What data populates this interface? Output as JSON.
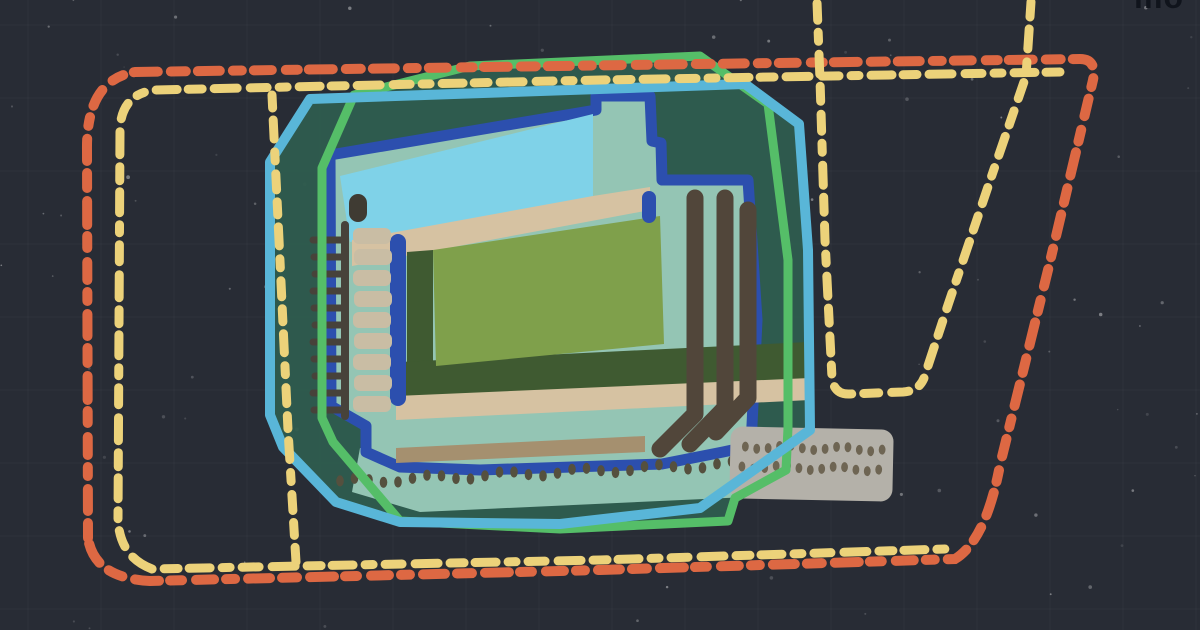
{
  "watermark": {
    "text": "mo",
    "color": "#10141c"
  },
  "scene": {
    "background": "#282c35",
    "grid_line": "#ffffff",
    "speckle": "#ffffff"
  },
  "boundaries": {
    "outer_route_color": "#dd6843",
    "inner_route_color": "#ecd27a"
  },
  "stadium": {
    "site_fill": "#2f5c4e",
    "site_outline_green": "#55be68",
    "site_outline_cyan": "#59b6d8",
    "stand_outline_blue": "#2c4fae",
    "stand_fill": "#94c5b4",
    "roof_fill": "#7fd2e8",
    "apron_tan": "#d6c2a2",
    "pitch_green": "#7fa04b",
    "pitch_border": "#3f5a31",
    "terrace_beige": "#c9bda4",
    "detail_dark": "#47423a",
    "stripe_brown": "#51463a",
    "stripe_tan": "#a5906f",
    "walkway_gray": "#b4b1a9",
    "walkway_dot": "#6e6553",
    "seat_dot": "#55503e"
  }
}
